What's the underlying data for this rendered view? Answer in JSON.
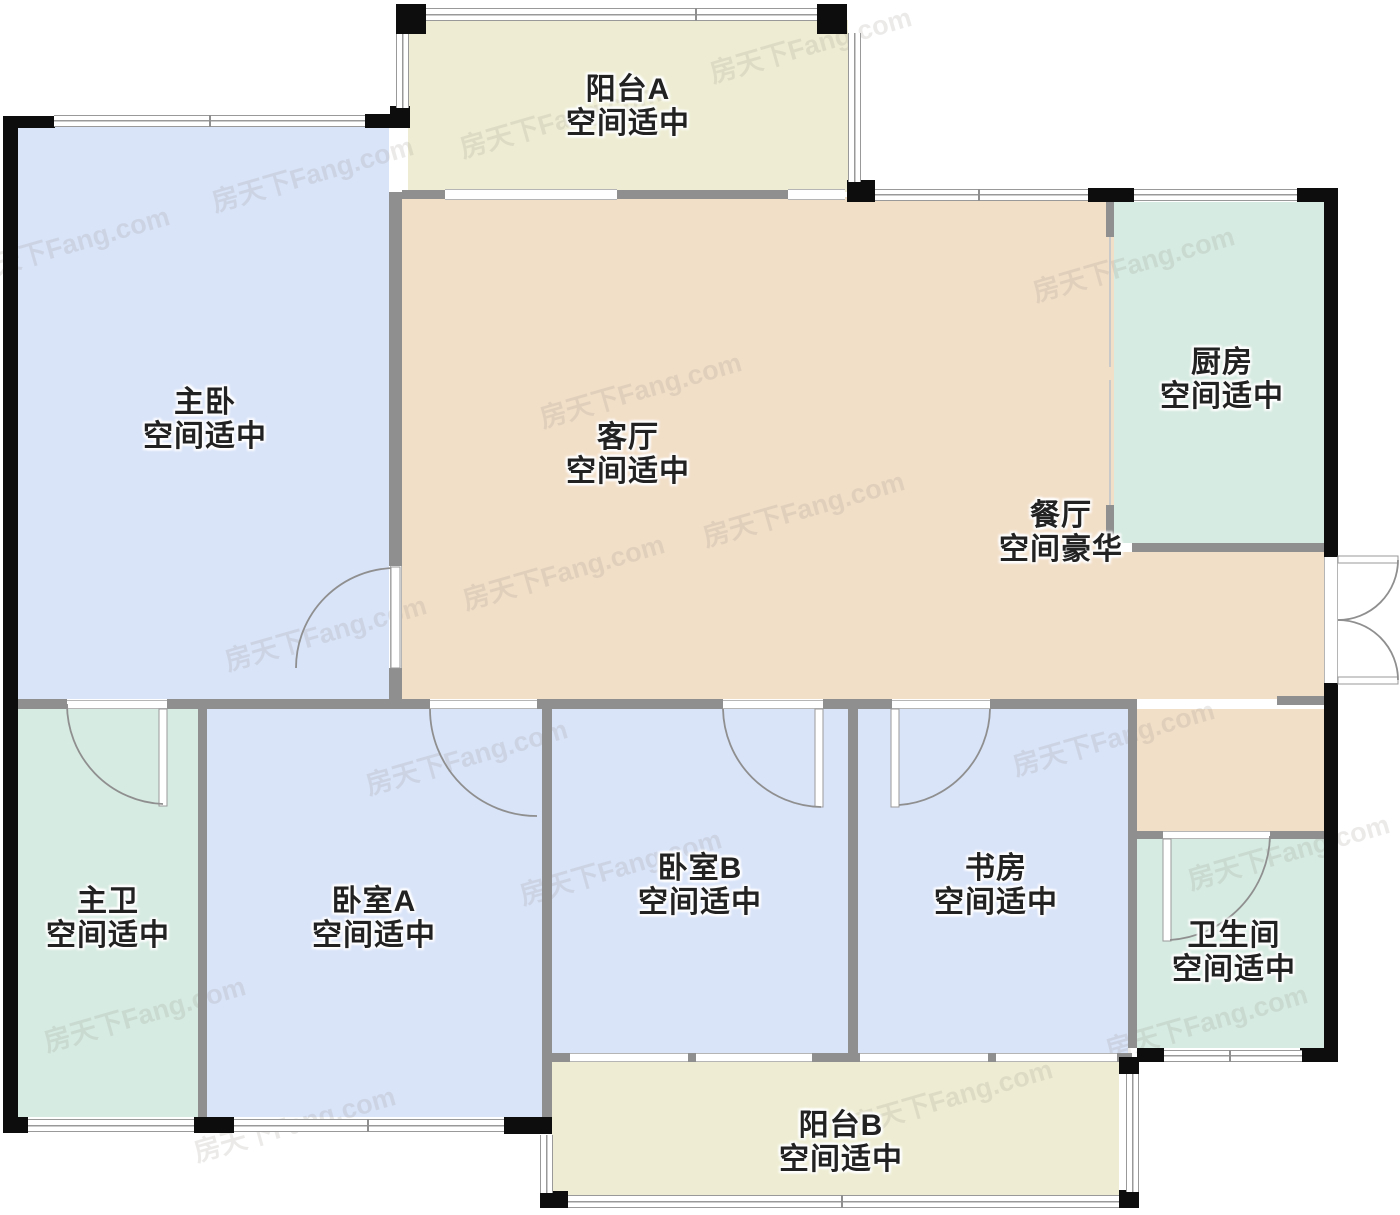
{
  "watermark": "房天下Fang.com",
  "colors": {
    "floor_bedroom": "#d9e4f9",
    "floor_balcony": "#eeedd3",
    "floor_living": "#f2dfc8",
    "floor_wet": "#d6ebe2",
    "wall_inner": "#8f8f8f",
    "wall_outer": "#0d0d0d",
    "label_text": "#222222",
    "watermark": "#8a857d"
  },
  "rooms": [
    {
      "id": "balcony-a",
      "name": "阳台A",
      "size": "空间适中"
    },
    {
      "id": "master-bedroom",
      "name": "主卧",
      "size": "空间适中"
    },
    {
      "id": "living-room",
      "name": "客厅",
      "size": "空间适中"
    },
    {
      "id": "kitchen",
      "name": "厨房",
      "size": "空间适中"
    },
    {
      "id": "dining-room",
      "name": "餐厅",
      "size": "空间豪华"
    },
    {
      "id": "master-bath",
      "name": "主卫",
      "size": "空间适中"
    },
    {
      "id": "bedroom-a",
      "name": "卧室A",
      "size": "空间适中"
    },
    {
      "id": "bedroom-b",
      "name": "卧室B",
      "size": "空间适中"
    },
    {
      "id": "study",
      "name": "书房",
      "size": "空间适中"
    },
    {
      "id": "bathroom",
      "name": "卫生间",
      "size": "空间适中"
    },
    {
      "id": "balcony-b",
      "name": "阳台B",
      "size": "空间适中"
    }
  ]
}
